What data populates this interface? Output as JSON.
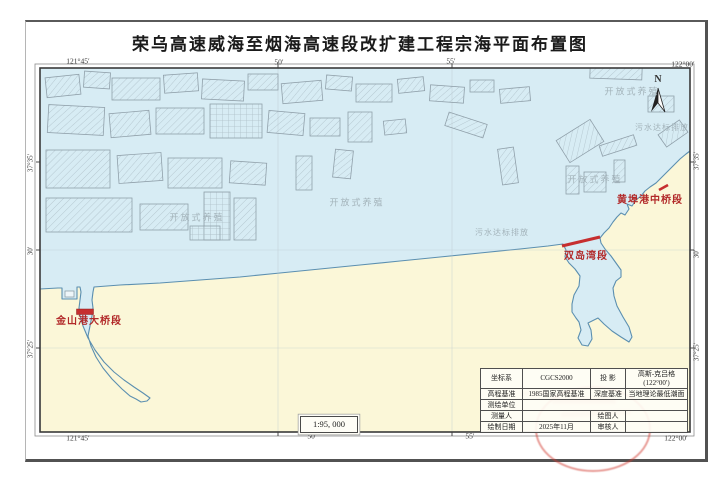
{
  "title": "荣乌高速威海至烟海高速段改扩建工程宗海平面布置图",
  "map": {
    "scale": "1:95, 000",
    "north_label": "N",
    "corner_labels": [
      {
        "text": "121°45′",
        "x": 78,
        "y": 61
      },
      {
        "text": "50′",
        "x": 279,
        "y": 62
      },
      {
        "text": "55′",
        "x": 451,
        "y": 61
      },
      {
        "text": "122°00′",
        "x": 683,
        "y": 64
      },
      {
        "text": "121°45′",
        "x": 78,
        "y": 438
      },
      {
        "text": "50′",
        "x": 312,
        "y": 436
      },
      {
        "text": "55′",
        "x": 470,
        "y": 436
      },
      {
        "text": "122°00′",
        "x": 676,
        "y": 438
      }
    ],
    "edge_labels": [
      {
        "text": "37°35′",
        "x": 31,
        "y": 163
      },
      {
        "text": "30′",
        "x": 31,
        "y": 251
      },
      {
        "text": "37°25′",
        "x": 31,
        "y": 349
      },
      {
        "text": "37°35′",
        "x": 697,
        "y": 161
      },
      {
        "text": "30′",
        "x": 697,
        "y": 254
      },
      {
        "text": "37°25′",
        "x": 697,
        "y": 352
      }
    ],
    "area_labels": [
      {
        "text": "开放式养殖",
        "x": 197,
        "y": 218,
        "color": "#a3b3ba",
        "size": 9,
        "spacing": 2
      },
      {
        "text": "开放式养殖",
        "x": 357,
        "y": 203,
        "color": "#a3b3ba",
        "size": 9,
        "spacing": 2
      },
      {
        "text": "污水达标排放",
        "x": 502,
        "y": 233,
        "color": "#a3b3ba",
        "size": 8,
        "spacing": 1
      },
      {
        "text": "开放式养殖",
        "x": 632,
        "y": 92,
        "color": "#a3b3ba",
        "size": 9,
        "spacing": 2
      },
      {
        "text": "污水达标排放",
        "x": 662,
        "y": 128,
        "color": "#a3b3ba",
        "size": 8,
        "spacing": 1
      },
      {
        "text": "开放式养殖",
        "x": 595,
        "y": 180,
        "color": "#a3b3ba",
        "size": 9,
        "spacing": 2
      }
    ],
    "section_labels": [
      {
        "text": "金山港大桥段",
        "x": 89,
        "y": 322,
        "color": "#b22a2a",
        "size": 10,
        "spacing": 1
      },
      {
        "text": "双岛湾段",
        "x": 586,
        "y": 257,
        "color": "#b22a2a",
        "size": 10,
        "spacing": 1
      },
      {
        "text": "黄埠港中桥段",
        "x": 650,
        "y": 201,
        "color": "#b22a2a",
        "size": 10,
        "spacing": 1
      }
    ],
    "colors": {
      "sea": "#d7ecf4",
      "land": "#fbf7d8",
      "coast": "#5b8fb0",
      "bridge_red": "#c62f2f"
    },
    "aquaculture_zones": [
      [
        46,
        76,
        34,
        20,
        -6
      ],
      [
        84,
        72,
        26,
        16,
        4
      ],
      [
        112,
        78,
        48,
        22,
        0
      ],
      [
        164,
        74,
        34,
        18,
        -4
      ],
      [
        202,
        80,
        42,
        20,
        3
      ],
      [
        248,
        74,
        30,
        16,
        0
      ],
      [
        282,
        82,
        40,
        20,
        -5
      ],
      [
        326,
        76,
        26,
        14,
        5
      ],
      [
        356,
        84,
        36,
        18,
        0
      ],
      [
        398,
        78,
        26,
        14,
        -6
      ],
      [
        430,
        86,
        34,
        16,
        4
      ],
      [
        470,
        80,
        24,
        12,
        0
      ],
      [
        500,
        88,
        30,
        14,
        -5
      ],
      [
        590,
        66,
        52,
        13,
        2
      ],
      [
        48,
        106,
        56,
        28,
        3
      ],
      [
        110,
        112,
        40,
        24,
        -5
      ],
      [
        156,
        108,
        48,
        26,
        0
      ],
      [
        210,
        104,
        52,
        34,
        0,
        "g"
      ],
      [
        268,
        112,
        36,
        22,
        5
      ],
      [
        310,
        118,
        30,
        18,
        0
      ],
      [
        348,
        112,
        24,
        30,
        0
      ],
      [
        384,
        120,
        22,
        14,
        -6
      ],
      [
        446,
        118,
        40,
        14,
        18
      ],
      [
        560,
        128,
        40,
        26,
        -32
      ],
      [
        600,
        140,
        36,
        11,
        -18
      ],
      [
        648,
        96,
        26,
        16,
        0
      ],
      [
        660,
        126,
        26,
        15,
        -35
      ],
      [
        46,
        150,
        64,
        38,
        0
      ],
      [
        118,
        154,
        44,
        28,
        -4
      ],
      [
        168,
        158,
        54,
        30,
        0
      ],
      [
        230,
        162,
        36,
        22,
        4
      ],
      [
        296,
        156,
        16,
        34,
        0
      ],
      [
        334,
        150,
        18,
        28,
        6
      ],
      [
        500,
        148,
        16,
        36,
        -8
      ],
      [
        566,
        166,
        13,
        28,
        0
      ],
      [
        584,
        172,
        22,
        20,
        0
      ],
      [
        614,
        160,
        11,
        22,
        0
      ],
      [
        46,
        198,
        86,
        34,
        0
      ],
      [
        140,
        204,
        48,
        26,
        0
      ],
      [
        204,
        192,
        26,
        48,
        0,
        "g"
      ],
      [
        234,
        198,
        22,
        42,
        0
      ],
      [
        190,
        226,
        30,
        14,
        0,
        "g"
      ]
    ]
  },
  "table": {
    "coord_label": "坐标系",
    "coord_value": "CGCS2000",
    "proj_label": "投 影",
    "proj_value": "高斯-克吕格",
    "proj_value2": "(122°00′)",
    "elev_label": "高程基准",
    "elev_value": "1985国家高程基准",
    "depth_label": "深度基准",
    "depth_value": "当地理论最低潮面",
    "survey_unit_label": "测绘单位",
    "survey_unit_value": "",
    "surveyor_label": "测量人",
    "surveyor_value": "",
    "drafter_label": "绘图人",
    "drafter_value": "",
    "date_label": "绘制日期",
    "date_value": "2025年11月",
    "checker_label": "审核人",
    "checker_value": ""
  }
}
